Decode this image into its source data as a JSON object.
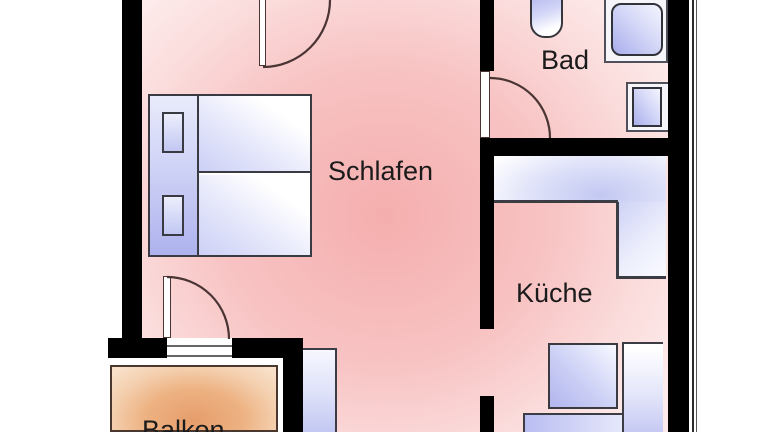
{
  "plan": {
    "type": "apartment-floor-plan",
    "rooms": {
      "schlafen": {
        "label": "Schlafen"
      },
      "bad": {
        "label": "Bad"
      },
      "kueche": {
        "label": "Küche"
      },
      "balkon": {
        "label": "Balkon"
      }
    },
    "fixtures": [
      "double-bed",
      "pillow",
      "pillow",
      "toilet",
      "shower",
      "washbasin",
      "kitchen-counter-l-shape",
      "stove",
      "kitchen-counter-right",
      "kitchen-counter-bottom",
      "hallway-cabinet",
      "balcony-floor"
    ],
    "doors": [
      "door-swing-schlafen-top",
      "door-swing-bad",
      "door-swing-balkon",
      "open-doorway-kueche"
    ],
    "colors": {
      "wall": "#000000",
      "floor_center": "#f5aeae",
      "floor_edge": "#fdeaea",
      "balcony_center": "#e79d6c",
      "balcony_edge": "#f8e0c9",
      "fixture_dark": "#aab0ec",
      "fixture_light": "#f7f8ff",
      "outline": "#3a3a42",
      "door_arc": "#4a3434"
    }
  }
}
